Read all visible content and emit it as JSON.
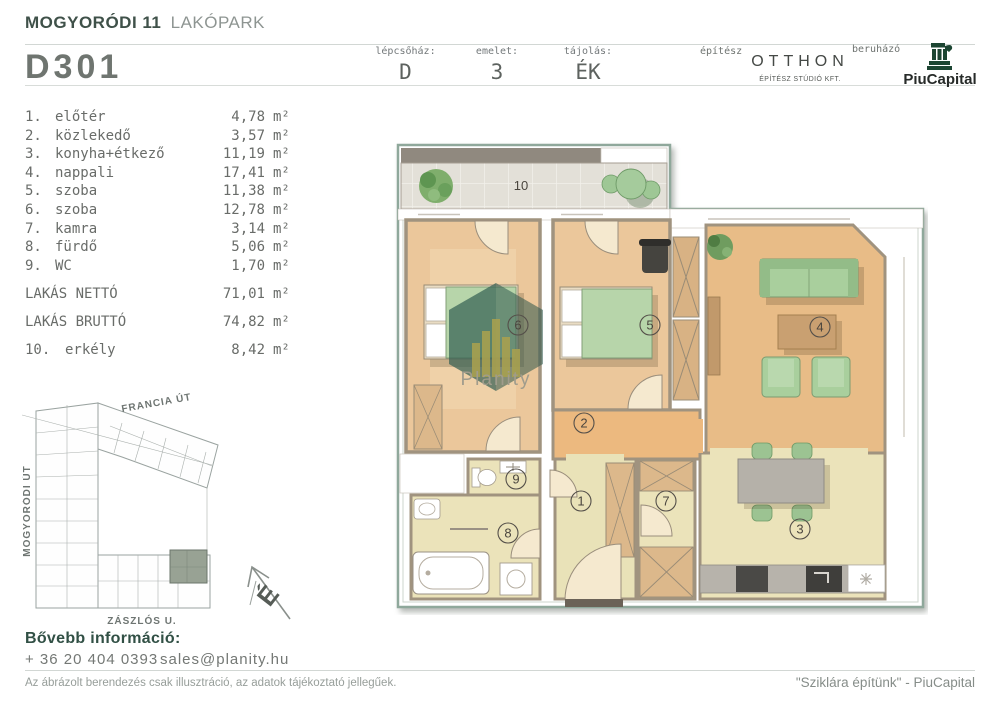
{
  "header": {
    "project_bold": "MOGYORÓDI 11",
    "project_light": "LAKÓPARK",
    "unit_id": "D301",
    "fields": [
      {
        "label": "lépcsőház:",
        "value": "D"
      },
      {
        "label": "emelet:",
        "value": "3"
      },
      {
        "label": "tájolás:",
        "value": "ÉK"
      }
    ],
    "architect_label": "építész",
    "architect_name": "OTTHON",
    "architect_sub": "ÉPÍTÉSZ STÚDIÓ KFT.",
    "developer_label": "beruházó",
    "developer_name": "PiuCapital"
  },
  "unit_sqm": "m²",
  "rooms": [
    {
      "num": "1.",
      "name": "előtér",
      "area": "4,78"
    },
    {
      "num": "2.",
      "name": "közlekedő",
      "area": "3,57"
    },
    {
      "num": "3.",
      "name": "konyha+étkező",
      "area": "11,19"
    },
    {
      "num": "4.",
      "name": "nappali",
      "area": "17,41"
    },
    {
      "num": "5.",
      "name": "szoba",
      "area": "11,38"
    },
    {
      "num": "6.",
      "name": "szoba",
      "area": "12,78"
    },
    {
      "num": "7.",
      "name": "kamra",
      "area": "3,14"
    },
    {
      "num": "8.",
      "name": "fürdő",
      "area": "5,06"
    },
    {
      "num": "9.",
      "name": "WC",
      "area": "1,70"
    }
  ],
  "summary": [
    {
      "name": "LAKÁS NETTÓ",
      "area": "71,01"
    },
    {
      "name": "LAKÁS BRUTTÓ",
      "area": "74,82"
    }
  ],
  "extra_room": {
    "num": "10.",
    "name": "erkély",
    "area": "8,42"
  },
  "site_map": {
    "street_top": "FRANCIA ÚT",
    "street_left": "MOGYORÓDI ÚT",
    "street_bottom": "ZÁSZLÓS U.",
    "compass": "É"
  },
  "plan": {
    "watermark": "Planity",
    "labels": {
      "r1": "1",
      "r2": "2",
      "r3": "3",
      "r4": "4",
      "r5": "5",
      "r6": "6",
      "r7": "7",
      "r8": "8",
      "r9": "9",
      "r10": "10"
    }
  },
  "contact": {
    "heading": "Bővebb információ:",
    "phone": "+ 36 20 404 0393",
    "email": "sales@planity.hu"
  },
  "footer": {
    "disclaimer": "Az ábrázolt berendezés csak illusztráció, az adatok tájékoztató jellegűek.",
    "slogan": "\"Sziklára építünk\" - PiuCapital"
  },
  "colors": {
    "accent_green": "#3f5149",
    "outline_sage": "#8fa89b",
    "floor_bedroom": "#ebc79b",
    "floor_hall": "#ecb97f",
    "floor_living": "#e8bc87",
    "floor_pale": "#ebe3ba",
    "furniture_green": "#a9cf9d",
    "highlight_unit": "#98a294"
  }
}
